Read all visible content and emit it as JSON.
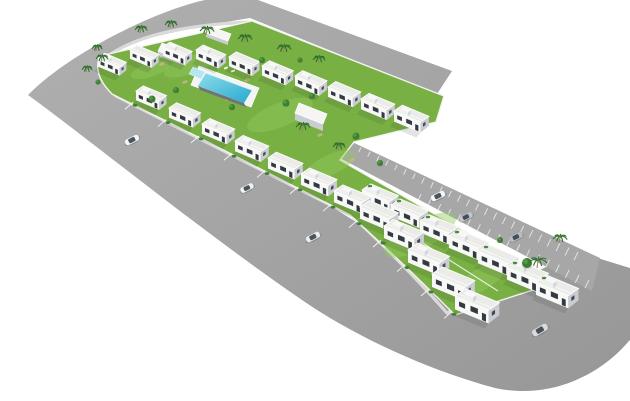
{
  "canvas": {
    "width": 630,
    "height": 401,
    "background": "#ffffff"
  },
  "colors": {
    "road_light": "#b0b0b0",
    "road_dark": "#979797",
    "parking_fill": "#a7a7a7",
    "parking_stripe": "#e6e6e6",
    "sidewalk": "#dadada",
    "site_grass": "#79b043",
    "grass_light": "#93c95e",
    "dirt_patch": "#c9b58c",
    "wall_white": "#f6f6f4",
    "roof": "#ebebe8",
    "roof_edge": "#fbfbfa",
    "house_front": "#f8f8f6",
    "house_side": "#c9cdd2",
    "window_dark": "#333a43",
    "pool_deck": "#f3f5f4",
    "pool_water_light": "#8edcea",
    "pool_water_deep": "#27a9cf",
    "pool_kids": "#b5e6f0",
    "pool_wall": "#707479",
    "palm_frond": "#2f6e2c",
    "palm_trunk": "#9b8462",
    "tree_green": "#3e7d34",
    "tree_highlight": "#58a047",
    "hedge_green": "#3a7a31",
    "car_glass": "#39414a",
    "shadow": "rgba(50,60,50,0.14)"
  },
  "road": {
    "path": "M452,71 L258,0 L205,0 C158,10 70,52 28,95 C90,140 200,230 302,300 C360,340 435,372 495,388 C550,400 600,375 628,342 L630,340 L630,268 L578,252 L480,298 Q350,218 255,160 L150,103 Q100,78 105,58 Q115,40 250,18 L437,94 Z"
  },
  "parking": {
    "quad": [
      [
        350,
        141
      ],
      [
        600,
        258
      ],
      [
        592,
        291
      ],
      [
        338,
        157
      ]
    ],
    "stripes_top": {
      "from": [
        352,
        143
      ],
      "to": [
        578,
        252
      ],
      "count": 26,
      "depth_min": 5,
      "depth_max": 9
    },
    "stripes_bottom": {
      "from": [
        340,
        158
      ],
      "to": [
        585,
        288
      ],
      "count": 26,
      "start_index": 8,
      "depth_min": 5,
      "depth_max": 9
    }
  },
  "sidewalks": [
    "M437,95 L252,22 Q150,26 108,56 Q94,78 116,96 L204,141 L352,216 Q402,262 447,313 L519,272",
    "M344,164 L552,282"
  ],
  "site": {
    "path": "M100,56 L252,21 L444,96 L436,122 L354,142 L340,160 L555,283 L455,315 Q400,260 350,215 L202,139 L112,94 Q92,74 100,56 Z"
  },
  "mid_wall": "M374,212 L498,291",
  "grass_patches": [
    [
      190,
      65,
      55,
      18,
      -20
    ],
    [
      280,
      115,
      70,
      24,
      -22
    ],
    [
      420,
      235,
      80,
      28,
      -28
    ],
    [
      330,
      165,
      55,
      20,
      -25
    ],
    [
      480,
      280,
      60,
      22,
      -30
    ],
    [
      150,
      70,
      40,
      14,
      -18
    ]
  ],
  "dirt_patches": [
    [
      185,
      82
    ],
    [
      228,
      99
    ],
    [
      268,
      71
    ],
    [
      300,
      116
    ],
    [
      162,
      64
    ],
    [
      247,
      80
    ],
    [
      320,
      135
    ],
    [
      352,
      160
    ]
  ],
  "pool": {
    "deck": [
      [
        199,
        66
      ],
      [
        259,
        88
      ],
      [
        251,
        107
      ],
      [
        191,
        85
      ]
    ],
    "kids": [
      [
        193,
        67
      ],
      [
        205,
        72
      ],
      [
        201,
        79
      ],
      [
        189,
        74
      ]
    ],
    "water": [
      [
        206,
        73
      ],
      [
        252,
        90
      ],
      [
        244,
        103
      ],
      [
        198,
        86
      ]
    ],
    "near_wall": [
      [
        198,
        86
      ],
      [
        244,
        103
      ],
      [
        246,
        107
      ],
      [
        200,
        90
      ]
    ],
    "far_edge": [
      [
        206,
        73
      ],
      [
        252,
        90
      ]
    ],
    "loungers": [
      [
        212,
        62
      ],
      [
        219,
        65
      ],
      [
        226,
        68
      ],
      [
        233,
        71
      ]
    ]
  },
  "structures": [
    {
      "roof": [
        [
          162,
          43
        ],
        [
          190,
          53
        ],
        [
          186,
          61
        ],
        [
          158,
          51
        ]
      ],
      "h": 5
    },
    {
      "roof": [
        [
          209,
          26
        ],
        [
          231,
          34
        ],
        [
          228,
          41
        ],
        [
          206,
          33
        ]
      ],
      "h": 4
    },
    {
      "roof": [
        [
          299,
          103
        ],
        [
          327,
          114
        ],
        [
          323,
          124
        ],
        [
          295,
          113
        ]
      ],
      "h": 7
    }
  ],
  "rows": [
    {
      "name": "row-north-terrace",
      "units": [
        {
          "x": 98,
          "y": 58,
          "s": 0.78
        },
        {
          "x": 130,
          "y": 50,
          "s": 0.79
        },
        {
          "x": 163,
          "y": 47,
          "s": 0.8
        },
        {
          "x": 196,
          "y": 50,
          "s": 0.82
        },
        {
          "x": 229,
          "y": 57,
          "s": 0.84
        },
        {
          "x": 262,
          "y": 66,
          "s": 0.86
        },
        {
          "x": 295,
          "y": 76,
          "s": 0.88
        },
        {
          "x": 328,
          "y": 87,
          "s": 0.9
        },
        {
          "x": 361,
          "y": 99,
          "s": 0.93
        },
        {
          "x": 394,
          "y": 111,
          "s": 0.96
        }
      ]
    },
    {
      "name": "row-parking-terrace",
      "units": [
        {
          "x": 362,
          "y": 190,
          "s": 1.0
        },
        {
          "x": 391,
          "y": 205,
          "s": 1.02
        },
        {
          "x": 420,
          "y": 221,
          "s": 1.05
        },
        {
          "x": 449,
          "y": 236,
          "s": 1.08
        },
        {
          "x": 478,
          "y": 251,
          "s": 1.11
        },
        {
          "x": 507,
          "y": 267,
          "s": 1.14
        },
        {
          "x": 536,
          "y": 282,
          "s": 1.17
        }
      ]
    },
    {
      "name": "row-front-terrace",
      "units": [
        {
          "x": 136,
          "y": 91,
          "s": 0.84
        },
        {
          "x": 169,
          "y": 108,
          "s": 0.87
        },
        {
          "x": 202,
          "y": 124,
          "s": 0.9
        },
        {
          "x": 235,
          "y": 141,
          "s": 0.93
        },
        {
          "x": 268,
          "y": 158,
          "s": 0.96
        },
        {
          "x": 301,
          "y": 174,
          "s": 0.99
        },
        {
          "x": 334,
          "y": 191,
          "s": 1.02
        },
        {
          "x": 360,
          "y": 207,
          "s": 1.06
        },
        {
          "x": 384,
          "y": 226,
          "s": 1.1
        },
        {
          "x": 408,
          "y": 250,
          "s": 1.14
        },
        {
          "x": 432,
          "y": 274,
          "s": 1.18
        },
        {
          "x": 455,
          "y": 296,
          "s": 1.22
        }
      ]
    }
  ],
  "palms": [
    [
      101,
      62,
      6
    ],
    [
      96,
      51,
      5
    ],
    [
      140,
      33,
      6
    ],
    [
      170,
      28,
      6
    ],
    [
      206,
      35,
      7
    ],
    [
      244,
      43,
      7
    ],
    [
      283,
      53,
      7
    ],
    [
      318,
      63,
      6
    ],
    [
      302,
      131,
      7
    ],
    [
      338,
      150,
      6
    ],
    [
      537,
      268,
      9
    ],
    [
      559,
      243,
      7
    ],
    [
      86,
      72,
      5
    ]
  ],
  "trees": [
    [
      152,
      99,
      3.5
    ],
    [
      176,
      90,
      3
    ],
    [
      262,
      60,
      3
    ],
    [
      286,
      103,
      3.5
    ],
    [
      312,
      96,
      3
    ],
    [
      356,
      136,
      3.5
    ],
    [
      380,
      163,
      3
    ],
    [
      98,
      82,
      2.5
    ],
    [
      232,
      107,
      3
    ],
    [
      527,
      263,
      5
    ],
    [
      500,
      240,
      3
    ],
    [
      300,
      60,
      2.5
    ]
  ],
  "cars": [
    {
      "x": 132,
      "y": 140,
      "angle": -27,
      "len": 15,
      "color": "#f5f5f5"
    },
    {
      "x": 247,
      "y": 188,
      "angle": -27,
      "len": 14,
      "color": "#f2f2f2"
    },
    {
      "x": 313,
      "y": 237,
      "angle": -28,
      "len": 15,
      "color": "#ededed"
    },
    {
      "x": 540,
      "y": 330,
      "angle": -31,
      "len": 17,
      "color": "#d9dbdd"
    },
    {
      "x": 438,
      "y": 196,
      "angle": -26,
      "len": 15,
      "color": "#f7f7f7"
    },
    {
      "x": 466,
      "y": 217,
      "angle": -26,
      "len": 14,
      "color": "#c3c7cb"
    },
    {
      "x": 516,
      "y": 237,
      "angle": -26,
      "len": 14,
      "color": "#b6bec4"
    }
  ]
}
